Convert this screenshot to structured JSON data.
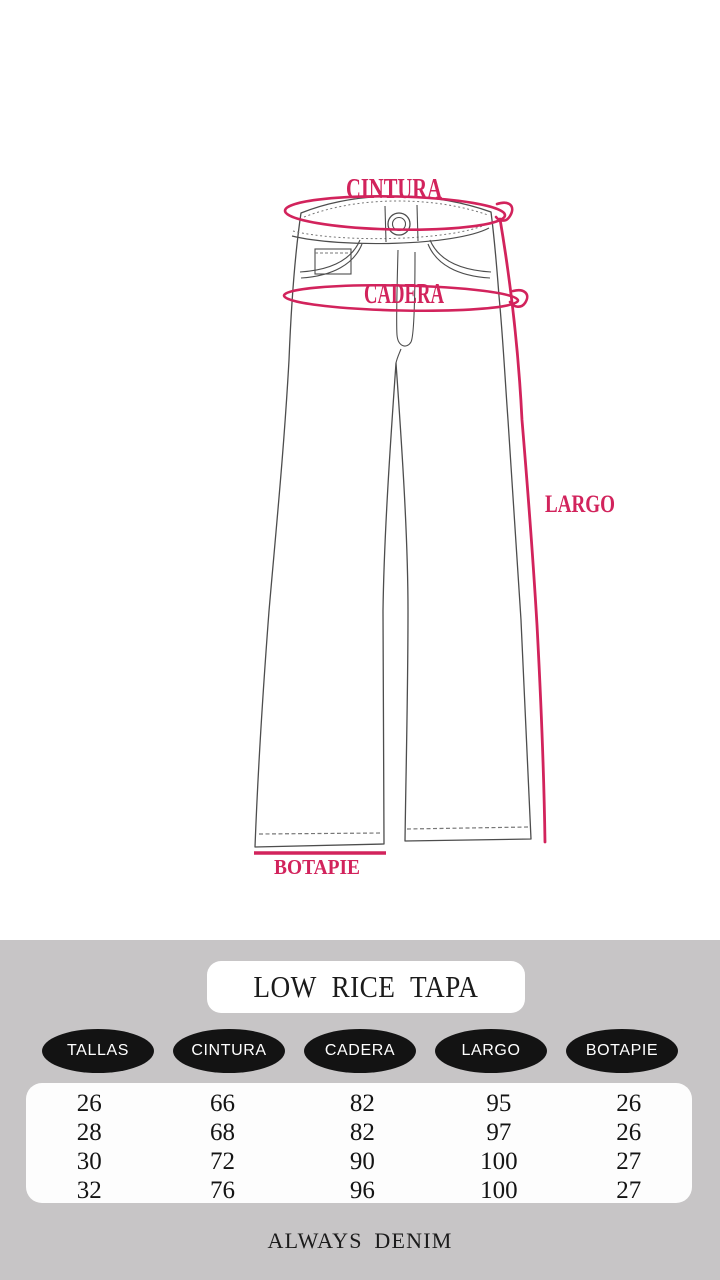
{
  "diagram": {
    "labels": {
      "cintura": "CINTURA",
      "cadera": "CADERA",
      "largo": "LARGO",
      "botapie": "BOTAPIE"
    },
    "accent_color": "#d2235c",
    "line_color": "#4d4d4d"
  },
  "panel": {
    "title": "LOW RICE TAPA",
    "columns": [
      "TALLAS",
      "CINTURA",
      "CADERA",
      "LARGO",
      "BOTAPIE"
    ],
    "rows": [
      [
        "26",
        "66",
        "82",
        "95",
        "26"
      ],
      [
        "28",
        "68",
        "82",
        "97",
        "26"
      ],
      [
        "30",
        "72",
        "90",
        "100",
        "27"
      ],
      [
        "32",
        "76",
        "96",
        "100",
        "27"
      ]
    ],
    "footer": "ALWAYS DENIM",
    "background_color": "#c7c5c6",
    "oval_color": "#131313"
  },
  "chart_data": {
    "type": "table",
    "title": "LOW RICE TAPA",
    "columns": [
      "TALLAS",
      "CINTURA",
      "CADERA",
      "LARGO",
      "BOTAPIE"
    ],
    "rows": [
      [
        26,
        66,
        82,
        95,
        26
      ],
      [
        28,
        68,
        82,
        97,
        26
      ],
      [
        30,
        72,
        90,
        100,
        27
      ],
      [
        32,
        76,
        96,
        100,
        27
      ]
    ],
    "footer": "ALWAYS DENIM"
  }
}
